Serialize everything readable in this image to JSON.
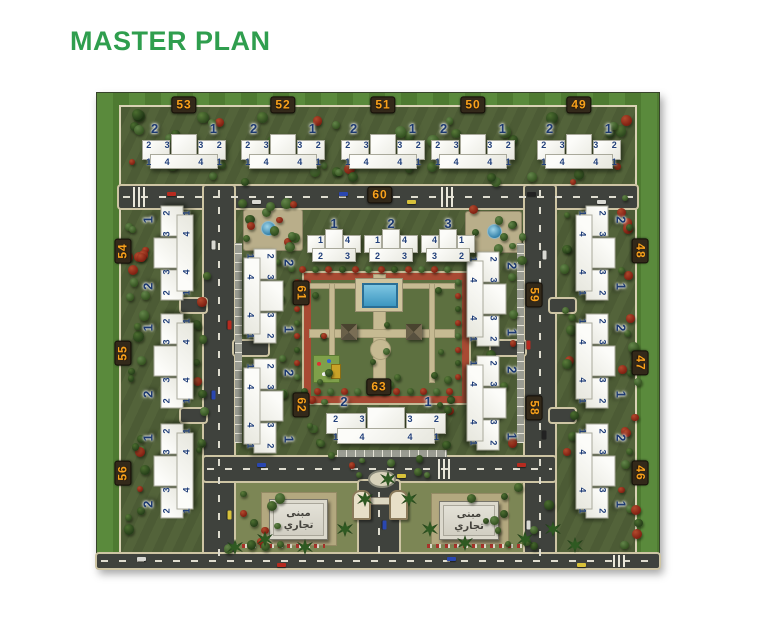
{
  "title": "MASTER PLAN",
  "colors": {
    "title": "#2f9e4e",
    "badge_text": "#f8a11c",
    "badge_bg": "#33291a",
    "unit_number": "#1d3a70",
    "lawn_light": "#5a8a3c",
    "lawn_dark": "#4e7a31",
    "site_ground": "#53633a",
    "road": "#3f423d",
    "path": "#cec5a4",
    "courtyard_walk": "#a84a33",
    "pool": "#3c96c0",
    "building": "#f2f2ec"
  },
  "map": {
    "commercial_label": {
      "line1": "مبنى",
      "line2": "تجاري"
    },
    "cluster_defaults": {
      "big": [
        "2",
        "1"
      ],
      "row1": [
        "2",
        "3",
        "3",
        "2"
      ],
      "row2": [
        "1",
        "4",
        "4",
        "1"
      ]
    },
    "blocks": [
      {
        "number": "46",
        "badge": {
          "x": 543,
          "y": 380,
          "rot": 90
        },
        "clusters": [
          {
            "cx": 502,
            "cy": 378,
            "rot": 90,
            "w": 95,
            "h": 56
          }
        ]
      },
      {
        "number": "47",
        "badge": {
          "x": 543,
          "y": 270,
          "rot": 90
        },
        "clusters": [
          {
            "cx": 502,
            "cy": 268,
            "rot": 90,
            "w": 95,
            "h": 56
          }
        ]
      },
      {
        "number": "48",
        "badge": {
          "x": 543,
          "y": 158,
          "rot": 90
        },
        "clusters": [
          {
            "cx": 502,
            "cy": 160,
            "rot": 90,
            "w": 95,
            "h": 56
          }
        ]
      },
      {
        "number": "49",
        "badge": {
          "x": 482,
          "y": 12,
          "rot": 0
        },
        "clusters": [
          {
            "cx": 482,
            "cy": 54,
            "rot": 0,
            "w": 84,
            "h": 50
          }
        ]
      },
      {
        "number": "50",
        "badge": {
          "x": 376,
          "y": 12,
          "rot": 0
        },
        "clusters": [
          {
            "cx": 376,
            "cy": 54,
            "rot": 0,
            "w": 84,
            "h": 50
          }
        ]
      },
      {
        "number": "51",
        "badge": {
          "x": 286,
          "y": 12,
          "rot": 0
        },
        "clusters": [
          {
            "cx": 286,
            "cy": 54,
            "rot": 0,
            "w": 84,
            "h": 50
          }
        ]
      },
      {
        "number": "52",
        "badge": {
          "x": 186,
          "y": 12,
          "rot": 0
        },
        "clusters": [
          {
            "cx": 186,
            "cy": 54,
            "rot": 0,
            "w": 84,
            "h": 50
          }
        ]
      },
      {
        "number": "53",
        "badge": {
          "x": 87,
          "y": 12,
          "rot": 0
        },
        "clusters": [
          {
            "cx": 87,
            "cy": 54,
            "rot": 0,
            "w": 84,
            "h": 50
          }
        ]
      },
      {
        "number": "54",
        "badge": {
          "x": 26,
          "y": 158,
          "rot": -90
        },
        "clusters": [
          {
            "cx": 72,
            "cy": 160,
            "rot": -90,
            "w": 95,
            "h": 56
          }
        ]
      },
      {
        "number": "55",
        "badge": {
          "x": 26,
          "y": 260,
          "rot": -90
        },
        "clusters": [
          {
            "cx": 72,
            "cy": 268,
            "rot": -90,
            "w": 95,
            "h": 56
          }
        ]
      },
      {
        "number": "56",
        "badge": {
          "x": 26,
          "y": 380,
          "rot": -90
        },
        "clusters": [
          {
            "cx": 72,
            "cy": 378,
            "rot": -90,
            "w": 95,
            "h": 56
          }
        ]
      },
      {
        "number": "58",
        "badge": {
          "x": 437,
          "y": 315,
          "rot": 90
        },
        "clusters": [
          {
            "cx": 393,
            "cy": 310,
            "rot": 90,
            "w": 95,
            "h": 56
          }
        ]
      },
      {
        "number": "59",
        "badge": {
          "x": 437,
          "y": 202,
          "rot": 90
        },
        "clusters": [
          {
            "cx": 393,
            "cy": 206,
            "rot": 90,
            "w": 95,
            "h": 56
          }
        ]
      },
      {
        "number": "60",
        "badge": {
          "x": 283,
          "y": 102,
          "rot": 0
        },
        "clusters": [
          {
            "cx": 237,
            "cy": 148,
            "rot": 0,
            "w": 54,
            "h": 48,
            "big": [
              "1"
            ],
            "row1": [
              "1",
              "4"
            ],
            "row2": [
              "2",
              "3"
            ]
          },
          {
            "cx": 294,
            "cy": 148,
            "rot": 0,
            "w": 54,
            "h": 48,
            "big": [
              "2"
            ],
            "row1": [
              "1",
              "4"
            ],
            "row2": [
              "2",
              "3"
            ]
          },
          {
            "cx": 351,
            "cy": 148,
            "rot": 0,
            "w": 54,
            "h": 48,
            "big": [
              "3"
            ],
            "row1": [
              "4",
              "1"
            ],
            "row2": [
              "3",
              "2"
            ]
          }
        ]
      },
      {
        "number": "61",
        "badge": {
          "x": 204,
          "y": 200,
          "rot": 90
        },
        "clusters": [
          {
            "cx": 170,
            "cy": 203,
            "rot": 90,
            "w": 95,
            "h": 56
          }
        ]
      },
      {
        "number": "62",
        "badge": {
          "x": 204,
          "y": 312,
          "rot": 90
        },
        "clusters": [
          {
            "cx": 170,
            "cy": 313,
            "rot": 90,
            "w": 95,
            "h": 56
          }
        ]
      },
      {
        "number": "63",
        "badge": {
          "x": 282,
          "y": 294,
          "rot": 0
        },
        "clusters": [
          {
            "cx": 289,
            "cy": 328,
            "rot": 0,
            "w": 120,
            "h": 52
          }
        ]
      }
    ]
  }
}
